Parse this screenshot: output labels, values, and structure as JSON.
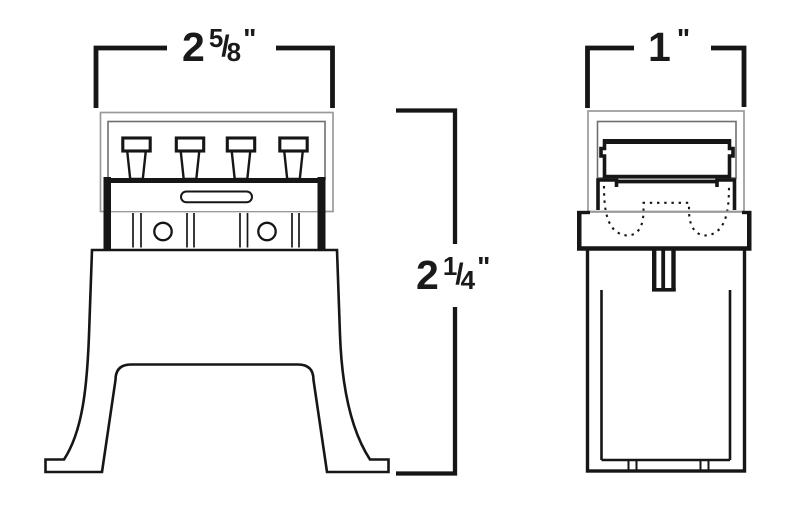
{
  "dims": {
    "front_width": {
      "whole": "2",
      "numerator": "5",
      "separator": "/",
      "denominator": "8",
      "unit": "\""
    },
    "height": {
      "whole": "2",
      "numerator": "1",
      "separator": "/",
      "denominator": "4",
      "unit": "\""
    },
    "side_width": {
      "whole": "1",
      "unit": "\""
    }
  },
  "colors": {
    "line": "#161616",
    "light_line": "#9a9a9a",
    "mid_line": "#6f6f6f",
    "background": "#ffffff"
  }
}
